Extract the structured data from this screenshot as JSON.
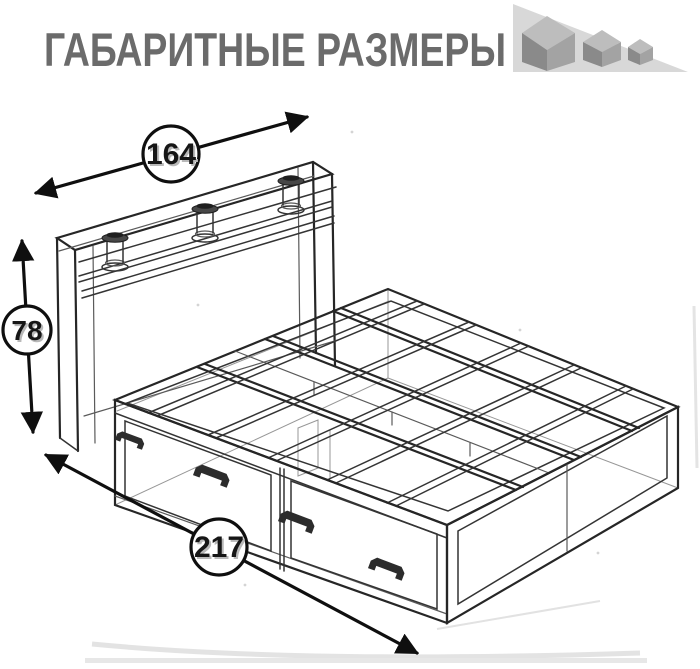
{
  "header": {
    "title": "ГАБАРИТНЫЕ РАЗМЕРЫ",
    "title_color": "#6b6b6b",
    "logo": {
      "icon": "decreasing-cubes-icon",
      "triangle_color": "#d8d8d8",
      "cube_top_color": "#bdbdbd",
      "cube_front_color": "#8a8a8a",
      "cube_side_color": "#a3a3a3"
    }
  },
  "diagram": {
    "subject": "bed-with-headboard-shelf-and-two-underbed-drawers",
    "style": "transparent-wireframe-perspective-sketch",
    "line_color": "#343434",
    "dimension_color": "#0f0f0f",
    "badge_fill": "#ffffff",
    "dimensions": {
      "width": {
        "label": "164"
      },
      "height": {
        "label": "78"
      },
      "length": {
        "label": "217"
      }
    }
  }
}
